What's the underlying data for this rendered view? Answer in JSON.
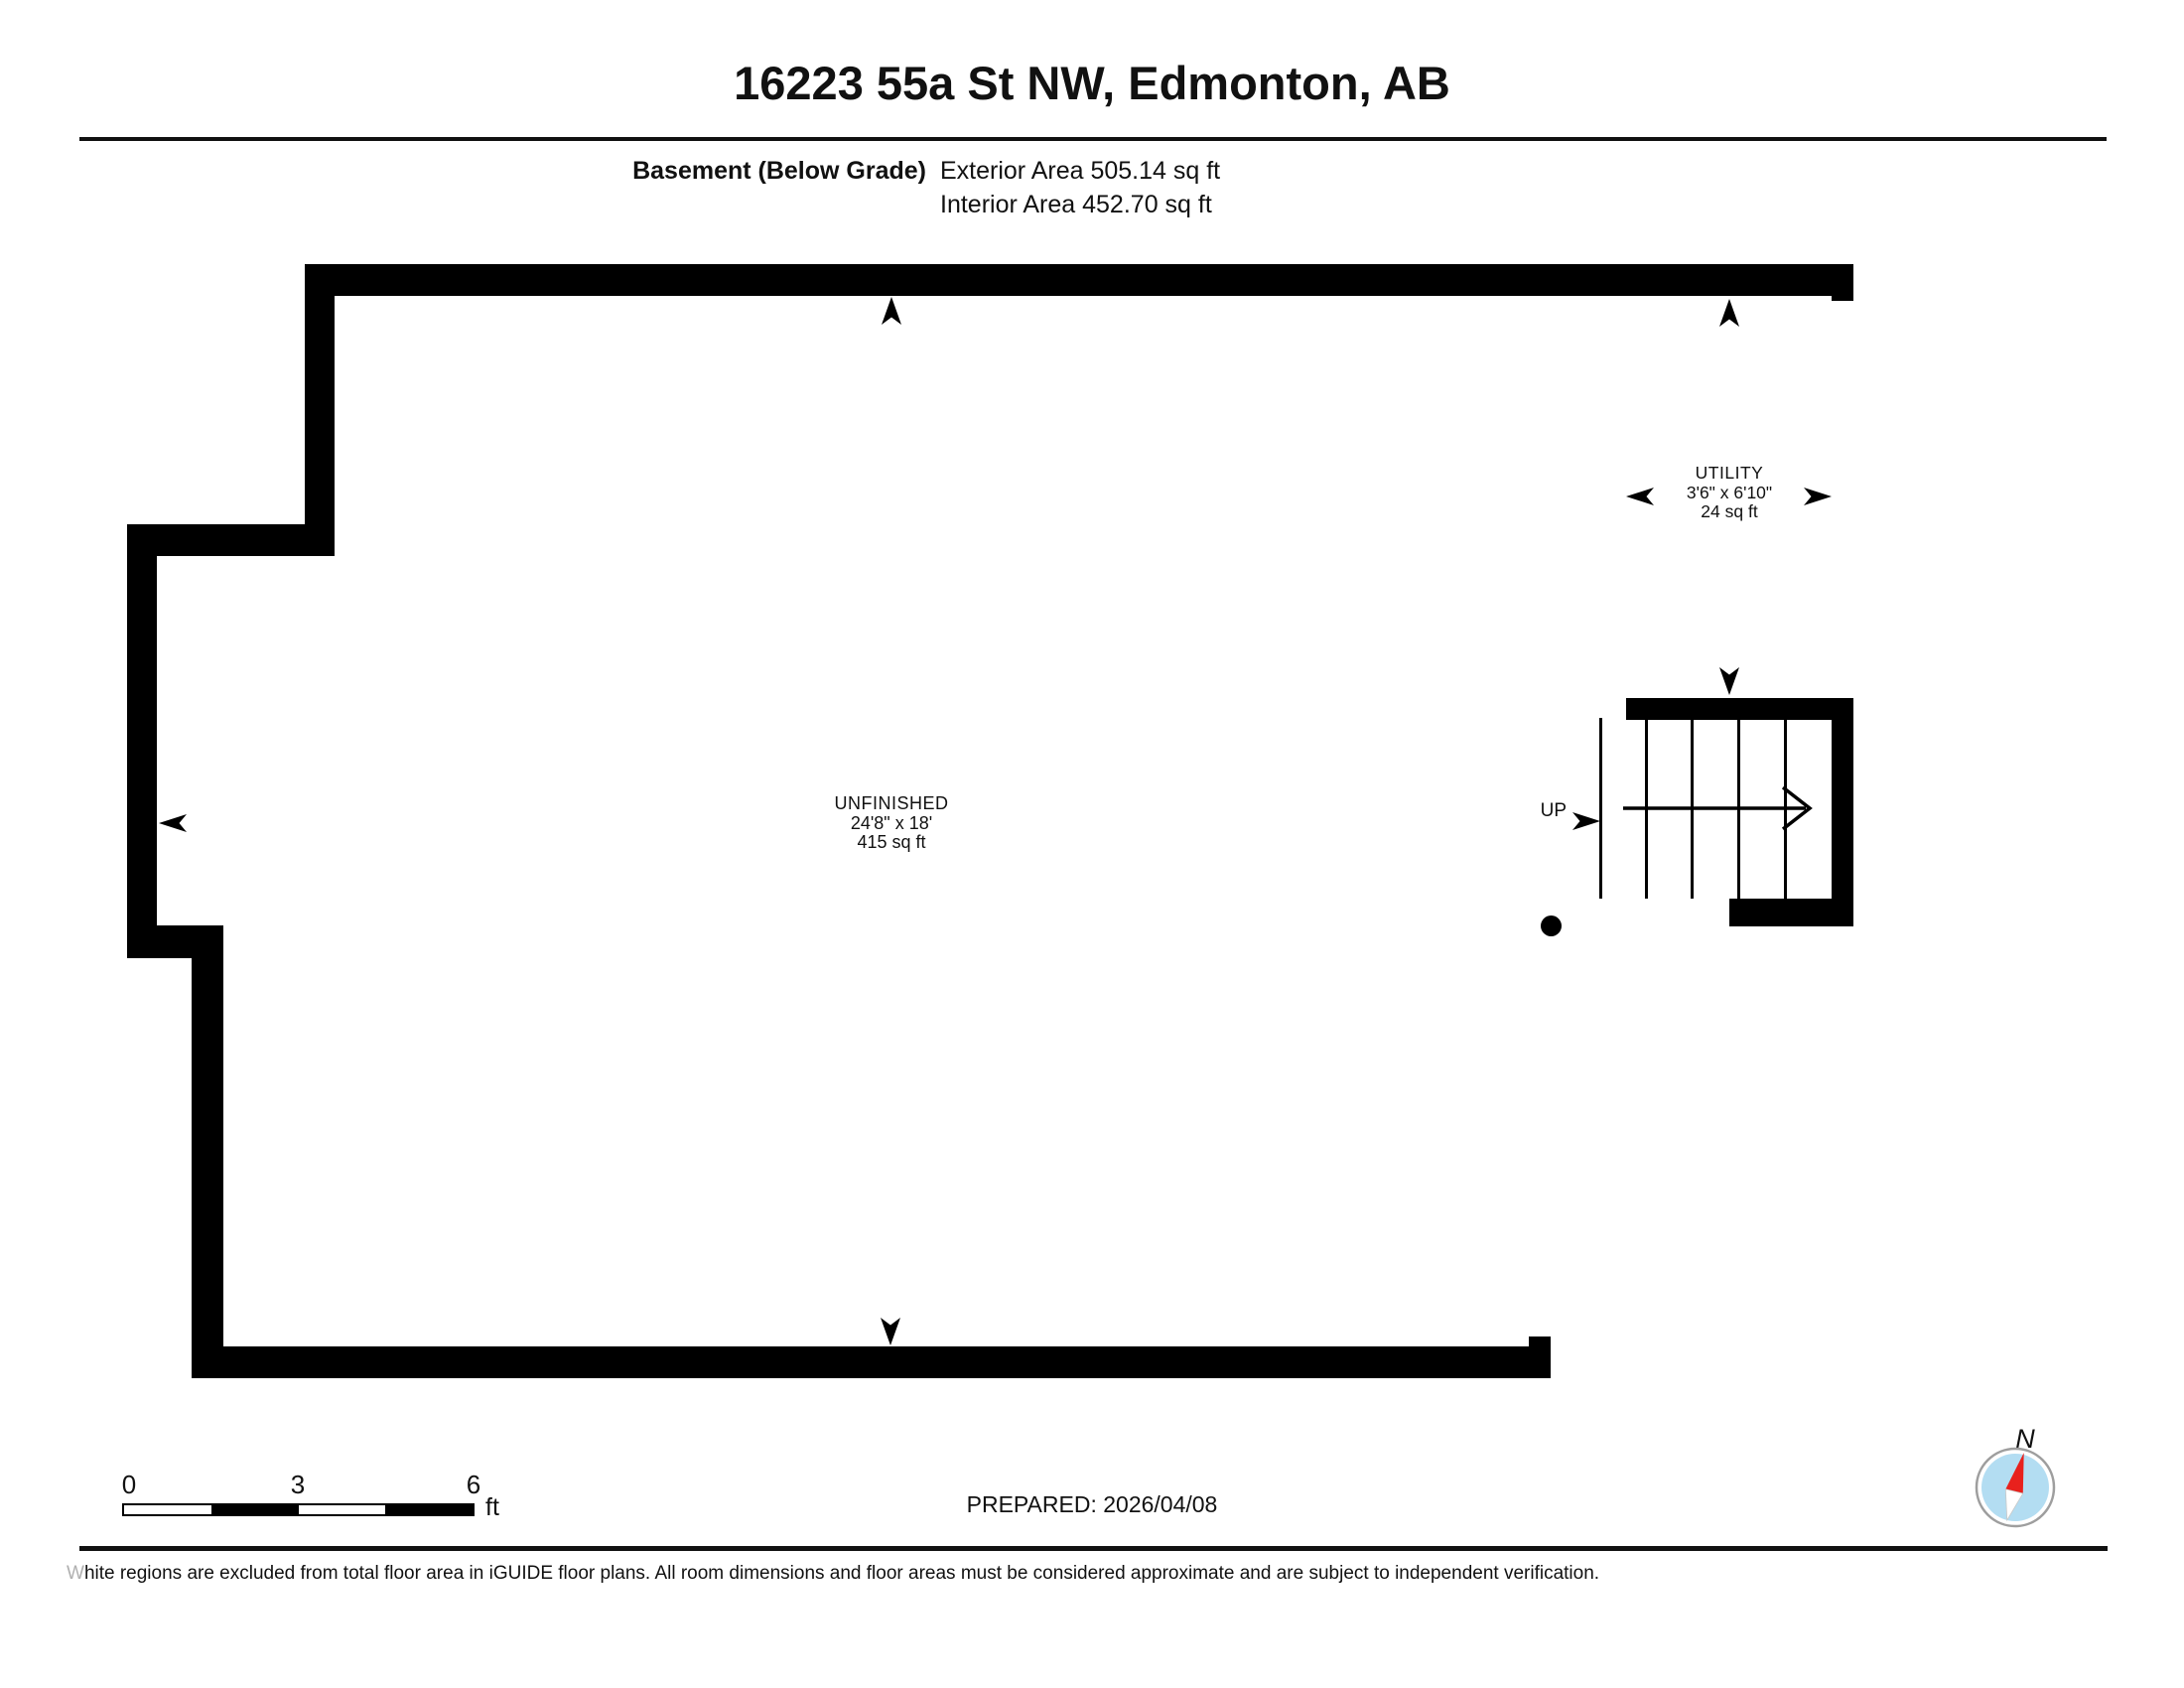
{
  "header": {
    "title": "16223 55a St NW, Edmonton, AB",
    "floor_label": "Basement (Below Grade)",
    "exterior_area": "Exterior Area 505.14 sq ft",
    "interior_area": "Interior Area 452.70 sq ft"
  },
  "rooms": {
    "unfinished": {
      "name": "UNFINISHED",
      "dimensions": "24'8\" x 18'",
      "area": "415 sq ft"
    },
    "utility": {
      "name": "UTILITY",
      "dimensions": "3'6\" x 6'10\"",
      "area": "24 sq ft"
    }
  },
  "stairs": {
    "direction_label": "UP"
  },
  "scale_bar": {
    "tick_0": "0",
    "tick_1": "3",
    "tick_2": "6",
    "unit": "ft"
  },
  "footer": {
    "prepared": "PREPARED: 2026/04/08",
    "disclaimer_lead": "W",
    "disclaimer_rest": "hite regions are excluded from total floor area in iGUIDE floor plans. All room dimensions and floor areas must be considered approximate and are subject to independent verification."
  },
  "compass": {
    "north_label": "N"
  },
  "colors": {
    "wall": "#000000",
    "compass_ring": "#9e9e9e",
    "compass_face": "#b3ddf2",
    "compass_north": "#e8211d",
    "compass_south": "#ffffff"
  }
}
